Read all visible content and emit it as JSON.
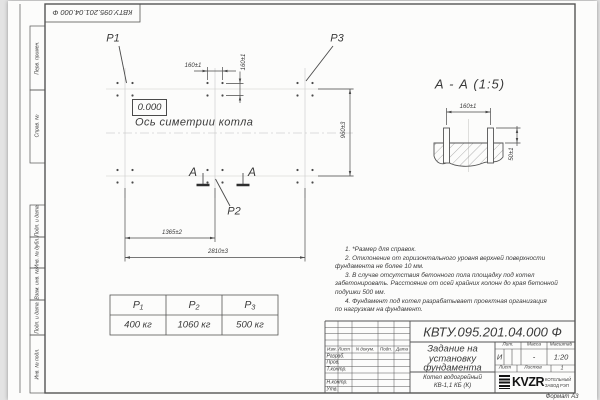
{
  "stamp_rotated": "КВТУ.095.201.04.000  Ф",
  "sidebar": {
    "labels": [
      "Перв. примен.",
      "Справ. №",
      "Подп. и дата",
      "Инв. № дубл.",
      "Взам. инв. №",
      "Подп. и дата",
      "Инв. № подл."
    ]
  },
  "plan": {
    "p1": "P1",
    "p2": "P2",
    "p3": "P3",
    "level": "0.000",
    "axis_label": "Ось симетрии котла",
    "section_letter": "А",
    "dims": {
      "group_h": "160±1",
      "group_v": "160±1",
      "height": "960±3",
      "mid": "1365±2",
      "total": "2810±3"
    }
  },
  "section_view": {
    "title": "А - А (1:5)",
    "dim_spacing": "160±1",
    "dim_protrusion": "50±1"
  },
  "notes": {
    "lines": [
      "1. *Размер для справок.",
      "2. Отклонение от горизонтального уровня верхней поверхности",
      "фундамента не более 10 мм.",
      "3. В случае отсутствия бетонного пола площадку под котел",
      "забетонировать. Расстояние от осей крайних колонн до края бетонной",
      "подушки 500 мм.",
      "4. Фундамент под котел разрабатывает проектная организация",
      "по нагрузкам на фундамент."
    ]
  },
  "load_table": {
    "headers": [
      "P₁",
      "P₂",
      "P₃"
    ],
    "values": [
      "400 кг",
      "1060 кг",
      "500 кг"
    ]
  },
  "title_block": {
    "doc_number": "КВТУ.095.201.04.000  Ф",
    "title_lines": [
      "Задание на",
      "установку",
      "фундамента"
    ],
    "product_lines": [
      "Котел водогрейный",
      "КВ-1,1 КБ  (К)"
    ],
    "cols": [
      "Изм. Лист",
      "N докум.",
      "Подп.",
      "Дата"
    ],
    "rows": [
      "Разраб.",
      "Пров.",
      "Т.контр.",
      "Н.контр.",
      "Утв."
    ],
    "lit_header": "Лит.",
    "mass_header": "Масса",
    "scale_header": "Масштаб",
    "lit": "И",
    "mass": "-",
    "scale": "1:20",
    "sheet_label": "Лист",
    "sheets_label": "Листов",
    "sheets_value": "1",
    "logo": {
      "text": "KVZR",
      "sub1": "КОТЕЛЬНЫЙ",
      "sub2": "ЗАВОД РЭП"
    },
    "format_label": "Формат А3"
  },
  "colors": {
    "ink": "#3a3a3a",
    "faint": "#c9c9c9",
    "paper": "#fcfcfb"
  }
}
